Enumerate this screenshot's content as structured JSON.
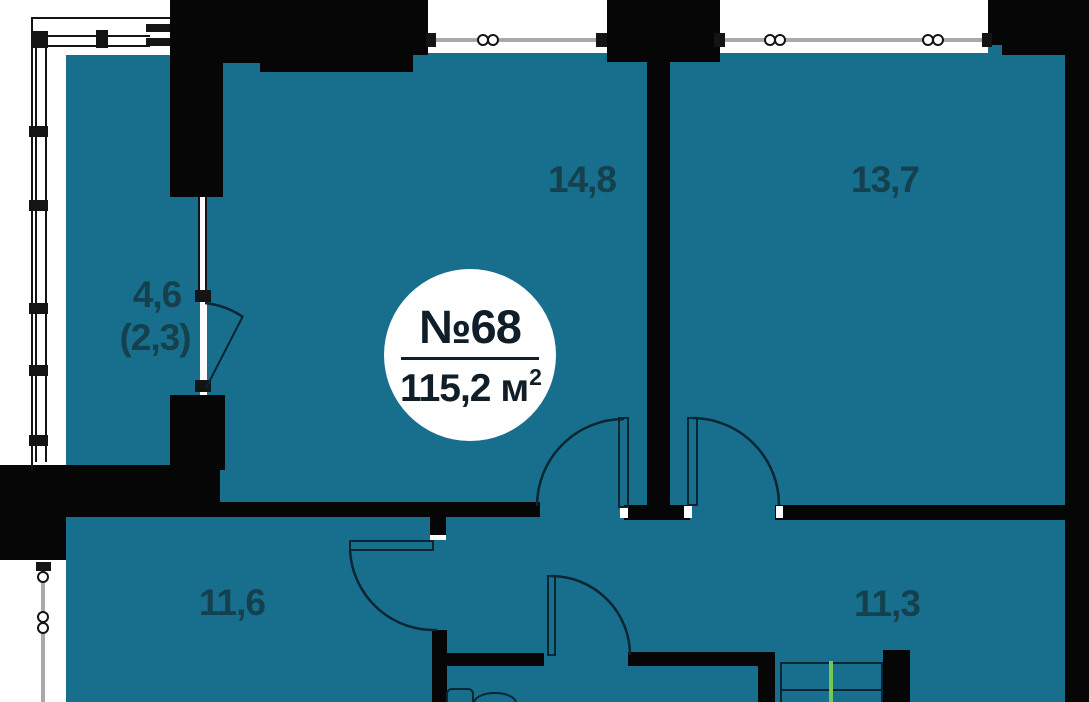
{
  "apartment": {
    "number": "№68",
    "area_value": "115,2",
    "area_unit": " м",
    "area_exponent": "2"
  },
  "rooms": [
    {
      "name": "living-room-top-middle",
      "label": "14,8"
    },
    {
      "name": "bedroom-top-right",
      "label": "13,7"
    },
    {
      "name": "balcony",
      "label": "4,6",
      "label_secondary": "(2,3)"
    },
    {
      "name": "room-bottom-left",
      "label": "11,6"
    },
    {
      "name": "room-bottom-right",
      "label": "11,3"
    }
  ],
  "colors": {
    "background": "#ffffff",
    "room_fill": "#176f8d",
    "wall": "#060606",
    "door_line": "#0b2531",
    "label_text": "#15404e",
    "badge_text": "#0f1e29",
    "window_gray": "#a9a9a9",
    "window_dark": "#141414",
    "wardrobe_green": "#76c94e"
  }
}
